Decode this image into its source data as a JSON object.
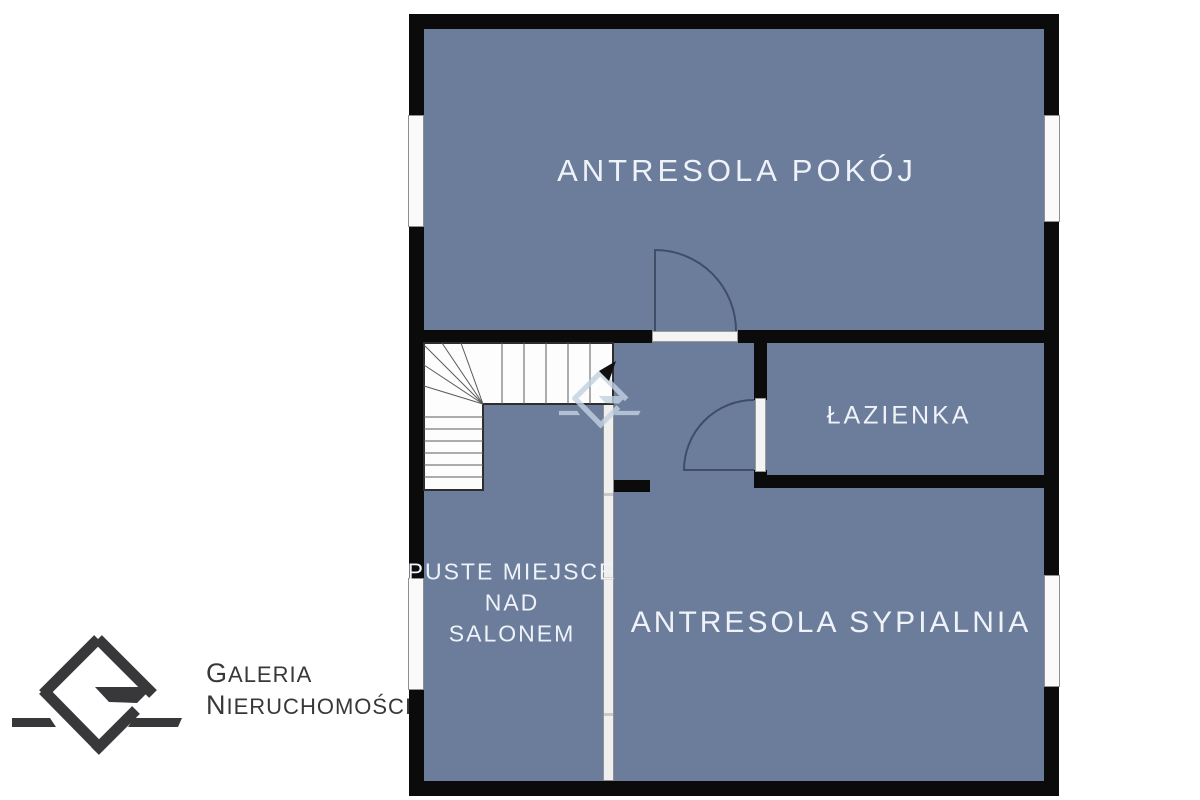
{
  "rooms": {
    "pokoj": {
      "label": "ANTRESOLA POKÓJ"
    },
    "lazienka": {
      "label": "ŁAZIENKA"
    },
    "puste": {
      "line1": "PUSTE MIEJSCE",
      "line2": "NAD",
      "line3": "SALONEM"
    },
    "sypialnia": {
      "label": "ANTRESOLA SYPIALNIA"
    }
  },
  "branding": {
    "name_line1": "GALERIA",
    "name_line2": "NIERUCHOMOŚCI"
  },
  "colors": {
    "floor": "#6b7d9b",
    "wall": "#0b0b0b",
    "label": "#eff3f9",
    "logotext": "#38383a",
    "watermark": "#c3d1e1",
    "doorarc": "#3d4e66",
    "stairline": "#5a5a5a"
  }
}
